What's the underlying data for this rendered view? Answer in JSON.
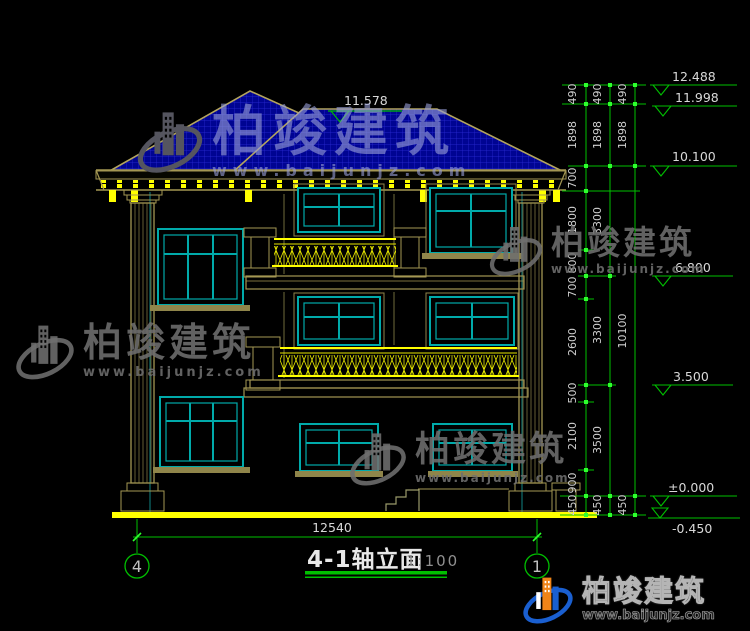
{
  "title": {
    "text": "4-1轴立面",
    "scale": "1:100"
  },
  "drawing": {
    "bottom_width_dim": "12540",
    "axis_bubbles": {
      "left": "4",
      "right": "1"
    },
    "roof_peak_elevation": "11.578",
    "elevation_levels": [
      "12.488",
      "11.998",
      "10.100",
      "6.800",
      "3.500",
      "±0.000",
      "-0.450"
    ],
    "dimension_chains": {
      "inner": [
        "490",
        "1898",
        "700",
        "1800",
        "800",
        "700",
        "2600",
        "500",
        "2100",
        "900",
        "450"
      ],
      "middle": [
        "490",
        "1898",
        "3300",
        "3300",
        "3500",
        "450"
      ],
      "outer": [
        "490",
        "1898",
        "10100",
        "450"
      ]
    }
  },
  "watermark": {
    "brand": "柏竣建筑",
    "url": "www.baijunjz.com"
  },
  "colors": {
    "dimension_green": "#00c000",
    "tick_green": "#2eff2e",
    "structure_tan": "#a49753",
    "window_cyan": "#00aaaa",
    "accent_yellow": "#ffff00",
    "roof_blue": "#000492",
    "text_white": "#d8d8d8"
  }
}
